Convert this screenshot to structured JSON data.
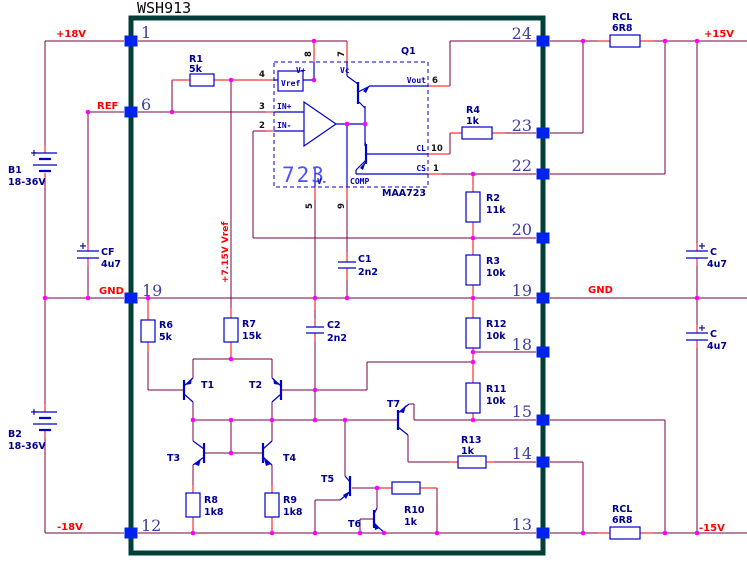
{
  "title": "WSH913",
  "net_labels": {
    "plus18": "+18V",
    "ref": "REF",
    "gnd_left": "GND",
    "minus18": "-18V",
    "plus15": "+15V",
    "minus15": "-15V",
    "gnd_right": "GND",
    "vref_rail": "+7.15V Vref"
  },
  "module_pins": {
    "left": [
      "1",
      "6",
      "19",
      "12"
    ],
    "right": [
      "24",
      "23",
      "22",
      "20",
      "19",
      "18",
      "15",
      "14",
      "13"
    ]
  },
  "ic723": {
    "designator": "Q1",
    "label_big": "723",
    "part": "MAA723",
    "vref_box": "Vref",
    "pin_labels": {
      "vplus": "V+",
      "vc": "Vc",
      "inplus": "IN+",
      "inminus": "IN-",
      "vout": "Vout",
      "cl": "CL",
      "cs": "CS",
      "vminus": "V-",
      "comp": "COMP"
    },
    "pin_numbers": {
      "vplus": "8",
      "vc": "7",
      "vref": "4",
      "inplus": "3",
      "inminus": "2",
      "vout": "6",
      "cl": "10",
      "cs": "1",
      "vminus": "5",
      "comp": "9"
    }
  },
  "resistors": {
    "R1": {
      "ref": "R1",
      "val": "5k"
    },
    "R2": {
      "ref": "R2",
      "val": "11k"
    },
    "R3": {
      "ref": "R3",
      "val": "10k"
    },
    "R4": {
      "ref": "R4",
      "val": "1k"
    },
    "R6": {
      "ref": "R6",
      "val": "5k"
    },
    "R7": {
      "ref": "R7",
      "val": "15k"
    },
    "R8": {
      "ref": "R8",
      "val": "1k8"
    },
    "R9": {
      "ref": "R9",
      "val": "1k8"
    },
    "R10": {
      "ref": "R10",
      "val": "1k"
    },
    "R11": {
      "ref": "R11",
      "val": "10k"
    },
    "R12": {
      "ref": "R12",
      "val": "10k"
    },
    "R13": {
      "ref": "R13",
      "val": "1k"
    },
    "RCL_top": {
      "ref": "RCL",
      "val": "6R8"
    },
    "RCL_bottom": {
      "ref": "RCL",
      "val": "6R8"
    }
  },
  "capacitors": {
    "C1": {
      "ref": "C1",
      "val": "2n2"
    },
    "C2": {
      "ref": "C2",
      "val": "2n2"
    },
    "CF": {
      "ref": "CF",
      "val": "4u7"
    },
    "C_top": {
      "ref": "C",
      "val": "4u7"
    },
    "C_bottom": {
      "ref": "C",
      "val": "4u7"
    }
  },
  "batteries": {
    "B1": {
      "ref": "B1",
      "val": "18-36V"
    },
    "B2": {
      "ref": "B2",
      "val": "18-36V"
    }
  },
  "transistors": {
    "T1": "T1",
    "T2": "T2",
    "T3": "T3",
    "T4": "T4",
    "T5": "T5",
    "T6": "T6",
    "T7": "T7"
  },
  "symbols": {
    "plus": "+"
  }
}
